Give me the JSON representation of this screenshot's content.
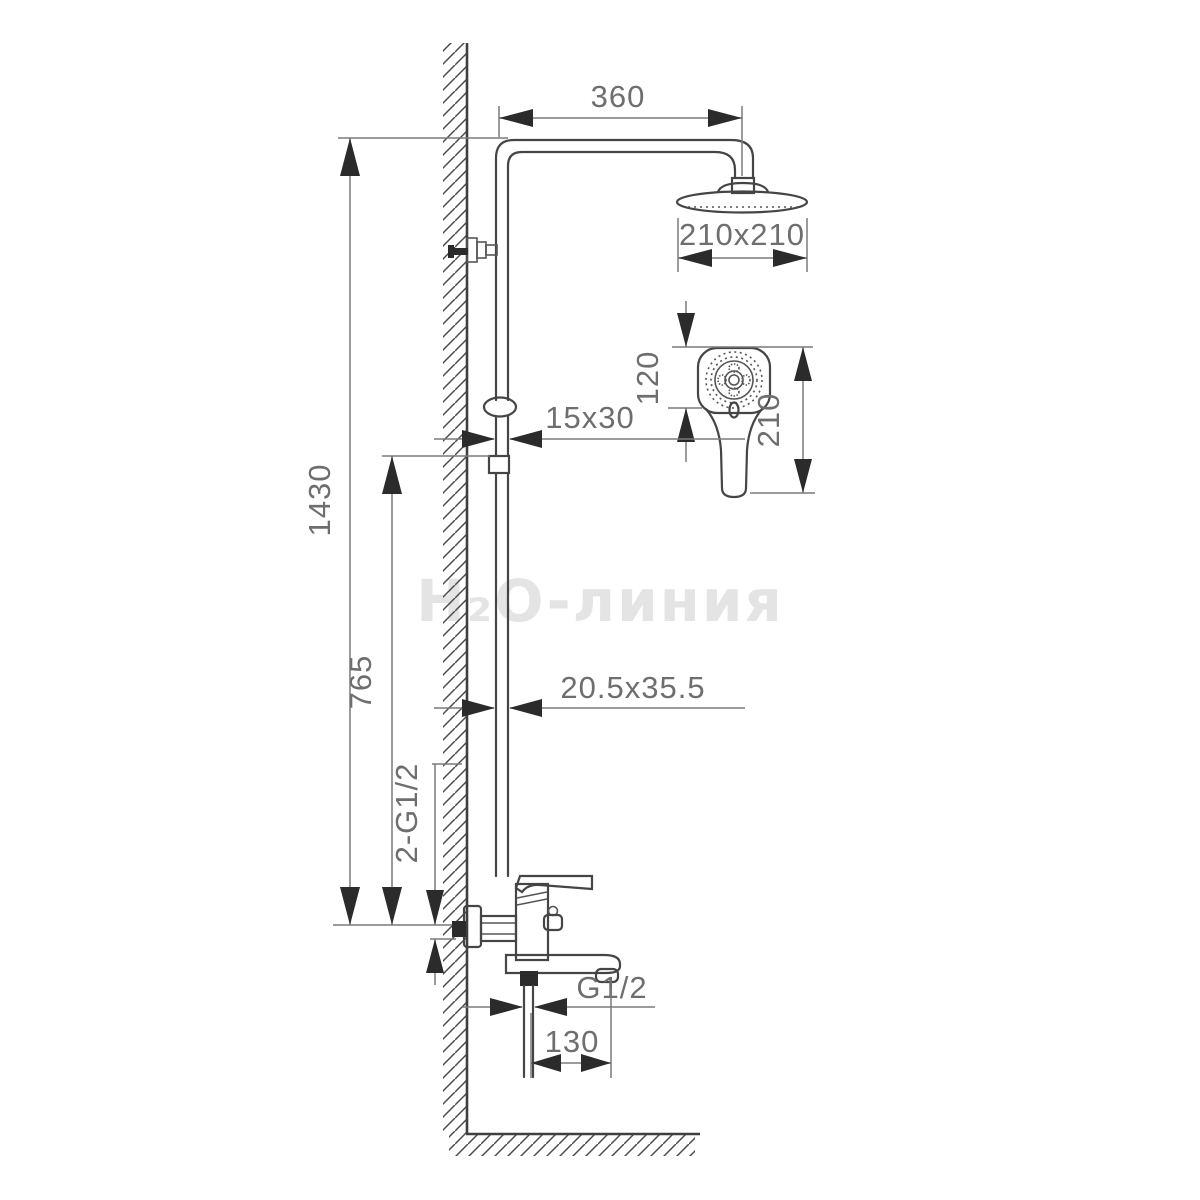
{
  "drawing": {
    "type": "technical-dimension-diagram",
    "subject": "wall-mounted shower column with overhead shower, hand shower and bath mixer",
    "watermark": {
      "text": "H₂O-линия",
      "color": "#e4e4e4"
    },
    "colors": {
      "background": "#ffffff",
      "outline": "#454545",
      "dimension_line": "#7a7a7a",
      "arrow_fill": "#2b2b2b",
      "dimension_text": "#6e6e6e"
    },
    "dimensions": {
      "arm_reach": {
        "label": "360"
      },
      "head_size": {
        "label": "210x210"
      },
      "handshower_face_height": {
        "label": "120"
      },
      "handshower_length": {
        "label": "210"
      },
      "slider_section": {
        "label": "15x30"
      },
      "column_section": {
        "label": "20.5x35.5"
      },
      "total_height": {
        "label": "1430"
      },
      "column_height": {
        "label": "765"
      },
      "wall_connections": {
        "label": "2-G1/2"
      },
      "spout_thread": {
        "label": "G1/2"
      },
      "spout_reach": {
        "label": "130"
      }
    }
  }
}
